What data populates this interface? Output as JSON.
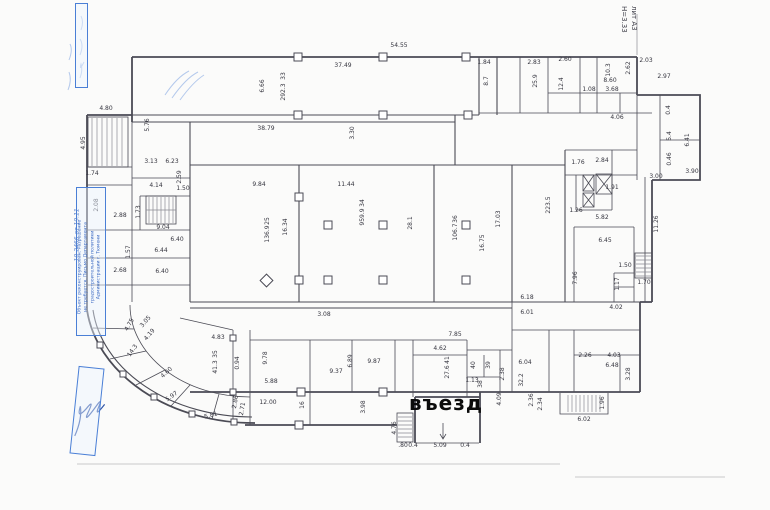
{
  "plan": {
    "entrance_label": "въезд",
    "liter_label": "лит А3",
    "height_label": "Н=3.33",
    "stamp": {
      "line1": "Объект реконструирован. Разрешение",
      "line2": "не требуется. Письмо Департамента",
      "line3": "градостроительной политики",
      "line4": "Администрации г. Тюмени",
      "note": "10-2466 от 19.11"
    },
    "colors": {
      "wall": "#4b4b55",
      "dim_text": "#35353f",
      "stamp_blue": "#4a7fd6",
      "page_line": "#c9c9c9",
      "pen_scribble": "#7aa0e0"
    }
  },
  "dims": [
    {
      "t": "54.55",
      "x": 399,
      "y": 46,
      "r": 0
    },
    {
      "t": "37.49",
      "x": 343,
      "y": 66,
      "r": 0
    },
    {
      "t": "6.66",
      "x": 263,
      "y": 86,
      "r": -90
    },
    {
      "t": "33",
      "x": 284,
      "y": 76,
      "r": -90
    },
    {
      "t": "292.3",
      "x": 284,
      "y": 92,
      "r": -90
    },
    {
      "t": "38.79",
      "x": 266,
      "y": 129,
      "r": 0
    },
    {
      "t": "3.30",
      "x": 353,
      "y": 133,
      "r": -90
    },
    {
      "t": "1.84",
      "x": 484,
      "y": 63,
      "r": 0
    },
    {
      "t": "8.7",
      "x": 487,
      "y": 81,
      "r": -90
    },
    {
      "t": "2.83",
      "x": 534,
      "y": 63,
      "r": 0
    },
    {
      "t": "2.60",
      "x": 565,
      "y": 60,
      "r": 0
    },
    {
      "t": "25.9",
      "x": 536,
      "y": 81,
      "r": -90
    },
    {
      "t": "12.4",
      "x": 562,
      "y": 84,
      "r": -90
    },
    {
      "t": "10.3",
      "x": 609,
      "y": 70,
      "r": -90
    },
    {
      "t": "2.62",
      "x": 629,
      "y": 68,
      "r": -90
    },
    {
      "t": "8.60",
      "x": 610,
      "y": 81,
      "r": 0
    },
    {
      "t": "3.68",
      "x": 612,
      "y": 90,
      "r": 0
    },
    {
      "t": "1.08",
      "x": 589,
      "y": 90,
      "r": 0
    },
    {
      "t": "4.06",
      "x": 617,
      "y": 118,
      "r": 0
    },
    {
      "t": "2.03",
      "x": 646,
      "y": 61,
      "r": 0
    },
    {
      "t": "2.97",
      "x": 664,
      "y": 77,
      "r": 0
    },
    {
      "t": "0.4",
      "x": 669,
      "y": 110,
      "r": -90
    },
    {
      "t": "5.4",
      "x": 670,
      "y": 136,
      "r": -90
    },
    {
      "t": "0.46",
      "x": 670,
      "y": 159,
      "r": -90
    },
    {
      "t": "6.41",
      "x": 688,
      "y": 140,
      "r": -90
    },
    {
      "t": "3.90",
      "x": 692,
      "y": 172,
      "r": 0
    },
    {
      "t": "3.00",
      "x": 656,
      "y": 177,
      "r": 0
    },
    {
      "t": "11.26",
      "x": 657,
      "y": 224,
      "r": -90
    },
    {
      "t": "1.70",
      "x": 644,
      "y": 283,
      "r": 0
    },
    {
      "t": "1.76",
      "x": 578,
      "y": 163,
      "r": 0
    },
    {
      "t": "2.84",
      "x": 602,
      "y": 161,
      "r": 0
    },
    {
      "t": "1.91",
      "x": 612,
      "y": 188,
      "r": 0
    },
    {
      "t": "1.26",
      "x": 576,
      "y": 211,
      "r": 0
    },
    {
      "t": "5.82",
      "x": 602,
      "y": 218,
      "r": 0
    },
    {
      "t": "6.45",
      "x": 605,
      "y": 241,
      "r": 0
    },
    {
      "t": "7.96",
      "x": 576,
      "y": 278,
      "r": -90
    },
    {
      "t": "1.50",
      "x": 625,
      "y": 266,
      "r": 0
    },
    {
      "t": "1.17",
      "x": 618,
      "y": 284,
      "r": -90
    },
    {
      "t": "4.02",
      "x": 616,
      "y": 308,
      "r": 0
    },
    {
      "t": "6.18",
      "x": 527,
      "y": 298,
      "r": 0
    },
    {
      "t": "6.01",
      "x": 527,
      "y": 313,
      "r": 0
    },
    {
      "t": "9.84",
      "x": 259,
      "y": 185,
      "r": 0
    },
    {
      "t": "16.34",
      "x": 286,
      "y": 227,
      "r": -90
    },
    {
      "t": "25",
      "x": 268,
      "y": 221,
      "r": -90
    },
    {
      "t": "136.9",
      "x": 268,
      "y": 234,
      "r": -90
    },
    {
      "t": "11.44",
      "x": 346,
      "y": 185,
      "r": 0
    },
    {
      "t": "34",
      "x": 363,
      "y": 203,
      "r": -90
    },
    {
      "t": "959.9",
      "x": 363,
      "y": 217,
      "r": -90
    },
    {
      "t": "28.1",
      "x": 411,
      "y": 223,
      "r": -90
    },
    {
      "t": "36",
      "x": 456,
      "y": 219,
      "r": -90
    },
    {
      "t": "106.7",
      "x": 456,
      "y": 232,
      "r": -90
    },
    {
      "t": "17.03",
      "x": 499,
      "y": 219,
      "r": -90
    },
    {
      "t": "16.75",
      "x": 483,
      "y": 243,
      "r": -90
    },
    {
      "t": "223.5",
      "x": 549,
      "y": 205,
      "r": -90
    },
    {
      "t": "3.08",
      "x": 324,
      "y": 315,
      "r": 0
    },
    {
      "t": "4.80",
      "x": 106,
      "y": 109,
      "r": 0
    },
    {
      "t": "4.95",
      "x": 84,
      "y": 143,
      "r": -90
    },
    {
      "t": "1.74",
      "x": 92,
      "y": 174,
      "r": 0
    },
    {
      "t": "5.76",
      "x": 148,
      "y": 125,
      "r": -90
    },
    {
      "t": "3.13",
      "x": 151,
      "y": 162,
      "r": 0
    },
    {
      "t": "6.23",
      "x": 172,
      "y": 162,
      "r": 0
    },
    {
      "t": "4.14",
      "x": 156,
      "y": 186,
      "r": 0
    },
    {
      "t": "1.50",
      "x": 183,
      "y": 189,
      "r": 0
    },
    {
      "t": "2.59",
      "x": 180,
      "y": 177,
      "r": -90
    },
    {
      "t": "9.04",
      "x": 163,
      "y": 228,
      "r": 0
    },
    {
      "t": "1.73",
      "x": 139,
      "y": 212,
      "r": -90
    },
    {
      "t": "2.88",
      "x": 120,
      "y": 216,
      "r": 0
    },
    {
      "t": "6.40",
      "x": 177,
      "y": 240,
      "r": 0
    },
    {
      "t": "6.44",
      "x": 161,
      "y": 251,
      "r": 0
    },
    {
      "t": "1.57",
      "x": 129,
      "y": 252,
      "r": -90
    },
    {
      "t": "2.68",
      "x": 120,
      "y": 271,
      "r": 0
    },
    {
      "t": "6.40",
      "x": 162,
      "y": 272,
      "r": 0
    },
    {
      "t": "2.08",
      "x": 97,
      "y": 205,
      "r": -90
    },
    {
      "t": "4.83",
      "x": 218,
      "y": 338,
      "r": 0
    },
    {
      "t": "35",
      "x": 216,
      "y": 354,
      "r": -90
    },
    {
      "t": "41.3",
      "x": 216,
      "y": 367,
      "r": -90
    },
    {
      "t": "0.94",
      "x": 238,
      "y": 363,
      "r": -90
    },
    {
      "t": "4.19",
      "x": 150,
      "y": 335,
      "r": -50
    },
    {
      "t": "14.3",
      "x": 133,
      "y": 351,
      "r": -55
    },
    {
      "t": "4.60",
      "x": 167,
      "y": 373,
      "r": -42
    },
    {
      "t": "5.97",
      "x": 172,
      "y": 397,
      "r": -35
    },
    {
      "t": "5.81",
      "x": 211,
      "y": 416,
      "r": -15
    },
    {
      "t": "2.86",
      "x": 236,
      "y": 402,
      "r": -80
    },
    {
      "t": "2.71",
      "x": 243,
      "y": 409,
      "r": -80
    },
    {
      "t": "3.05",
      "x": 146,
      "y": 322,
      "r": -50
    },
    {
      "t": "4.75",
      "x": 130,
      "y": 325,
      "r": -60
    },
    {
      "t": "9.78",
      "x": 266,
      "y": 358,
      "r": -90
    },
    {
      "t": "5.88",
      "x": 271,
      "y": 382,
      "r": 0
    },
    {
      "t": "9.37",
      "x": 336,
      "y": 372,
      "r": 0
    },
    {
      "t": "6.89",
      "x": 351,
      "y": 361,
      "r": -90
    },
    {
      "t": "9.87",
      "x": 374,
      "y": 362,
      "r": 0
    },
    {
      "t": "12.00",
      "x": 268,
      "y": 403,
      "r": 0
    },
    {
      "t": "16",
      "x": 303,
      "y": 405,
      "r": -90
    },
    {
      "t": "3.98",
      "x": 364,
      "y": 407,
      "r": -90
    },
    {
      "t": "7.85",
      "x": 455,
      "y": 335,
      "r": 0
    },
    {
      "t": "4.62",
      "x": 440,
      "y": 349,
      "r": 0
    },
    {
      "t": "41",
      "x": 448,
      "y": 360,
      "r": -90
    },
    {
      "t": "27.6",
      "x": 448,
      "y": 372,
      "r": -90
    },
    {
      "t": "4.76",
      "x": 395,
      "y": 428,
      "r": -90
    },
    {
      "t": ".80",
      "x": 403,
      "y": 446,
      "r": 0
    },
    {
      "t": "0.4",
      "x": 413,
      "y": 446,
      "r": 0
    },
    {
      "t": "5.09",
      "x": 440,
      "y": 446,
      "r": 0
    },
    {
      "t": "0.4",
      "x": 465,
      "y": 446,
      "r": 0
    },
    {
      "t": "40",
      "x": 474,
      "y": 365,
      "r": -90
    },
    {
      "t": "39",
      "x": 489,
      "y": 365,
      "r": -90
    },
    {
      "t": "1.13",
      "x": 472,
      "y": 381,
      "r": 0
    },
    {
      "t": "38",
      "x": 481,
      "y": 384,
      "r": -90
    },
    {
      "t": "2.38",
      "x": 503,
      "y": 374,
      "r": -90
    },
    {
      "t": "4.09",
      "x": 500,
      "y": 399,
      "r": -90
    },
    {
      "t": "2.36",
      "x": 532,
      "y": 400,
      "r": -90
    },
    {
      "t": "6.04",
      "x": 525,
      "y": 363,
      "r": 0
    },
    {
      "t": "2.26",
      "x": 585,
      "y": 356,
      "r": 0
    },
    {
      "t": "4.03",
      "x": 614,
      "y": 356,
      "r": 0
    },
    {
      "t": "6.48",
      "x": 612,
      "y": 366,
      "r": 0
    },
    {
      "t": "32.2",
      "x": 522,
      "y": 380,
      "r": -90
    },
    {
      "t": "3.28",
      "x": 629,
      "y": 374,
      "r": -90
    },
    {
      "t": "6.02",
      "x": 584,
      "y": 420,
      "r": 0
    },
    {
      "t": "2.34",
      "x": 541,
      "y": 404,
      "r": -90
    },
    {
      "t": "1.96",
      "x": 603,
      "y": 403,
      "r": -90
    }
  ]
}
